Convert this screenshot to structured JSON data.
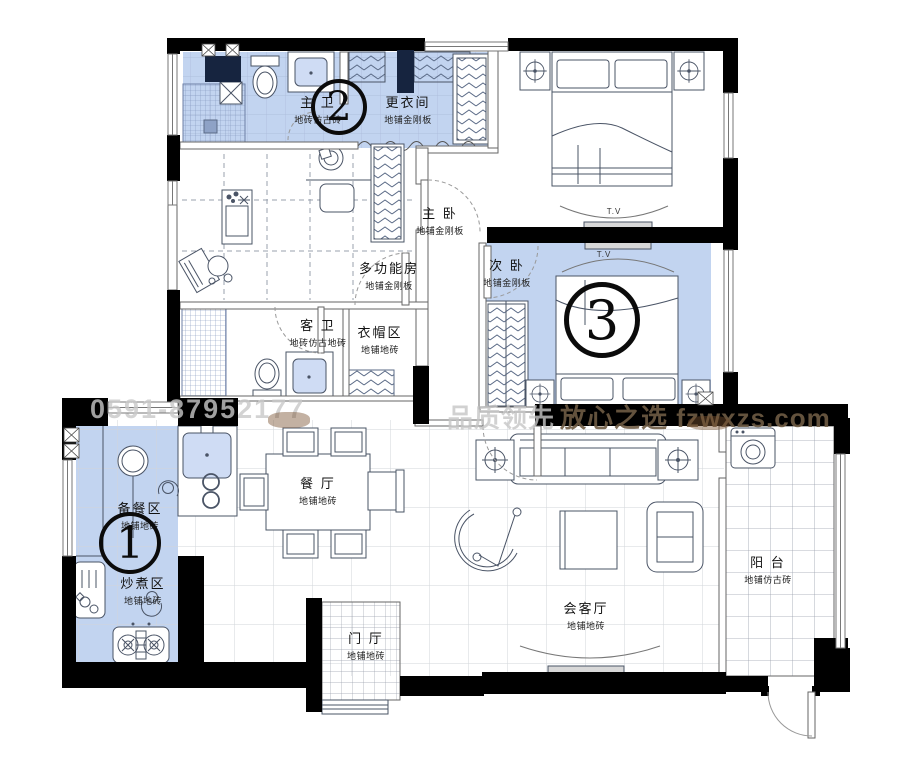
{
  "colors": {
    "highlight": "#c2d4f0",
    "wall": "#000000",
    "shaft": "#16243f",
    "furniture_line": "#4a5466",
    "watermark_light": "#c9c9c9",
    "watermark_dark": "#6e5b44"
  },
  "rooms": {
    "master_bath": {
      "name": "主 卫",
      "floor": "地砖仿古砖"
    },
    "dressing": {
      "name": "更衣间",
      "floor": "地铺金刚板"
    },
    "master_bedroom": {
      "name": "主 卧",
      "floor": "地铺金刚板"
    },
    "multi_room": {
      "name": "多功能房",
      "floor": "地铺金刚板"
    },
    "second_bedroom": {
      "name": "次 卧",
      "floor": "地铺金刚板"
    },
    "guest_bath": {
      "name": "客 卫",
      "floor": "地砖仿古地砖"
    },
    "cloak_area": {
      "name": "衣帽区",
      "floor": "地铺地砖"
    },
    "prep_area": {
      "name": "备餐区",
      "floor": "地铺地砖"
    },
    "cook_area": {
      "name": "炒煮区",
      "floor": "地铺地砖"
    },
    "dining": {
      "name": "餐 厅",
      "floor": "地铺地砖"
    },
    "living": {
      "name": "会客厅",
      "floor": "地铺地砖"
    },
    "hall": {
      "name": "门 厅",
      "floor": "地铺地砖"
    },
    "balcony": {
      "name": "阳 台",
      "floor": "地铺仿古砖"
    }
  },
  "markers": {
    "m1": "1",
    "m2": "2",
    "m3": "3"
  },
  "tv_label": "T.V",
  "watermarks": {
    "phone": "0591-87952177",
    "slogan_left": "品质领先",
    "slogan_right": "放心之选 fzwxzs.com"
  }
}
